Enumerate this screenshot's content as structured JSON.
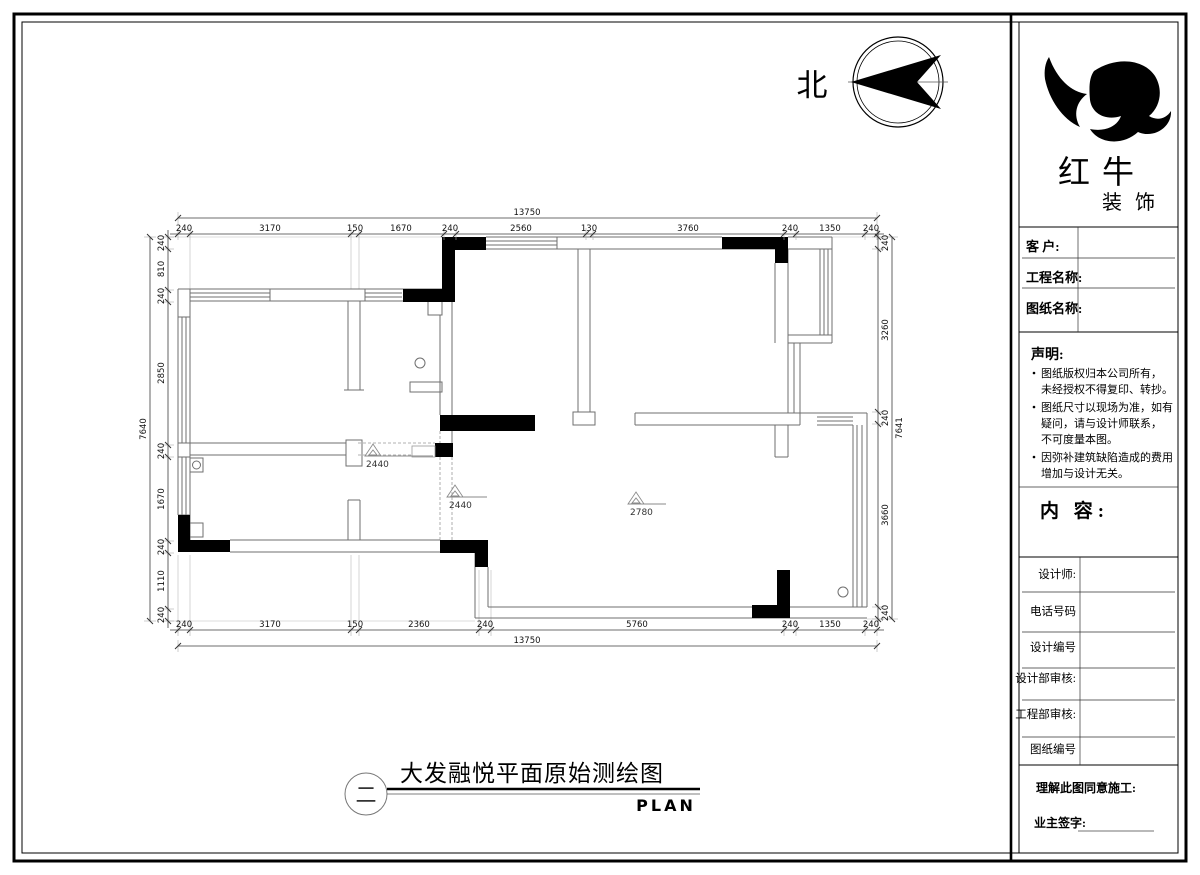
{
  "north_label": "北",
  "dims": {
    "top_overall": "13750",
    "bottom_overall": "13750",
    "left_overall": "7640",
    "right_overall": "7641",
    "top": [
      "240",
      "3170",
      "150",
      "1670",
      "240",
      "2560",
      "130",
      "3760",
      "240",
      "1350",
      "240"
    ],
    "bottom": [
      "240",
      "3170",
      "150",
      "2360",
      "240",
      "5760",
      "240",
      "1350",
      "240"
    ],
    "left": [
      "240",
      "810",
      "240",
      "2850",
      "240",
      "1670",
      "240",
      "1110",
      "240"
    ],
    "right": [
      "240",
      "3260",
      "240",
      "3660",
      "240"
    ]
  },
  "ceiling": [
    "2440",
    "2440",
    "2780"
  ],
  "footer": {
    "figure_number": "二",
    "title": "大发融悦平面原始测绘图",
    "subtitle": "PLAN"
  },
  "title_block": {
    "logo_title": "红 牛",
    "logo_subtitle": "装 饰",
    "fields": [
      "客 户:",
      "工程名称:",
      "图纸名称:"
    ],
    "statement_title": "声明:",
    "statement": {
      "item1": {
        "l1": "图纸版权归本公司所有，",
        "l2": "未经授权不得复印、转抄。"
      },
      "item2": {
        "l1": "图纸尺寸以现场为准，如有",
        "l2": "疑问，请与设计师联系，",
        "l3": "不可度量本图。"
      },
      "item3": {
        "l1": "因弥补建筑缺陷造成的费用",
        "l2": "增加与设计无关。"
      }
    },
    "content_label": "内 容:",
    "rows": [
      "设计师:",
      "电话号码",
      "设计编号",
      "设计部审核:",
      "工程部审核:",
      "图纸编号"
    ],
    "footer_note": "理解此图同意施工:",
    "signature_label": "业主签字:"
  },
  "colors": {
    "ink": "#000000",
    "wall_line": "#6f6f6f"
  }
}
